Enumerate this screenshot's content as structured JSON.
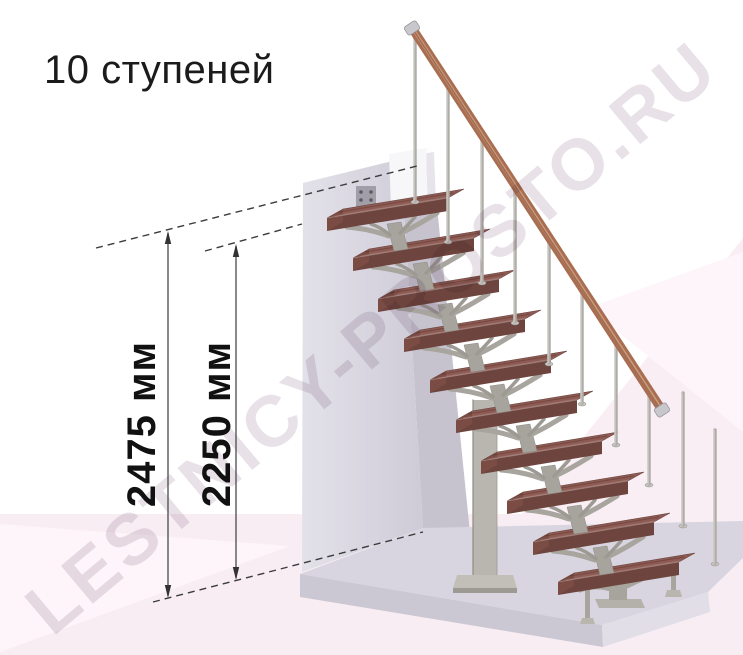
{
  "title": "10 ступеней",
  "watermark": "LESTNICY-PROSTO.RU",
  "diagram": {
    "steps_count": 10,
    "measurements": [
      {
        "id": "total-height",
        "label": "2475 мм"
      },
      {
        "id": "height-to-top-step",
        "label": "2250 мм"
      }
    ]
  },
  "colors": {
    "background": "#ffffff",
    "floor_pink": "#f8edf3",
    "floor_pink_light": "#fdf5f9",
    "backdrop_pink": "#f9eef4",
    "wall_light": "#e3e1e8",
    "wall_dark": "#cecbd8",
    "wall_side": "#c6c3cf",
    "wall_top": "#e9e7ed",
    "platform_top": "#d8d5e0",
    "platform_front": "#cbc8d4",
    "platform_side": "#e1dee7",
    "step_top": "#8d5b53",
    "step_front": "#6e453e",
    "step_side": "#7a4c44",
    "metal": "#a8a49e",
    "metal_dark": "#8e8a84",
    "metal_light": "#b9b5af",
    "handrail": "#a96e51",
    "handrail_highlight": "#d2a081",
    "handrail_shadow": "#7e4d39",
    "cap_silver": "#c8c8cc",
    "annotation": "#3c3c3c",
    "watermark_color": "#e8e1e7"
  }
}
